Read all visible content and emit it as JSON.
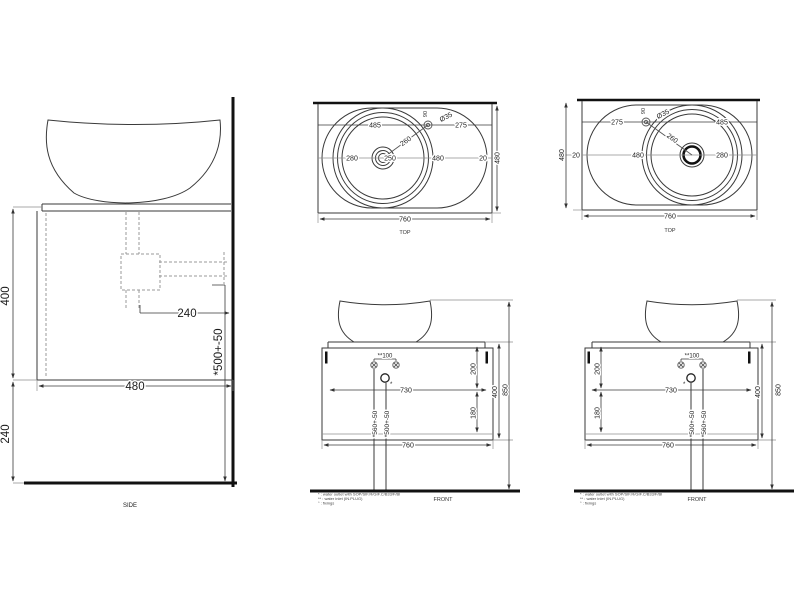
{
  "side": {
    "label": "SIDE",
    "dim_cabinet_height": "400",
    "dim_plinth_height": "240",
    "dim_depth": "480",
    "dim_trap_offset": "240",
    "dim_outlet_height": "*500+-50"
  },
  "top_a": {
    "label": "TOP",
    "dim_edge_to_tap": "485",
    "dim_tap_to_edge": "275",
    "dim_tap_hole": "Ø35",
    "dim_tap_setback": "90",
    "dim_tap_to_drain": "260",
    "dim_edge_to_drain": "280",
    "dim_drain_inner": "250",
    "dim_drain_to_edge": "480",
    "dim_back_gap": "20",
    "dim_depth": "480",
    "dim_width": "760"
  },
  "top_b": {
    "label": "TOP",
    "dim_edge_to_tap": "275",
    "dim_tap_to_edge": "485",
    "dim_tap_hole": "Ø35",
    "dim_tap_setback": "90",
    "dim_tap_to_drain": "260",
    "dim_edge_to_drain": "480",
    "dim_drain_to_edge": "280",
    "dim_back_gap": "20",
    "dim_depth": "480",
    "dim_width": "760"
  },
  "front_a": {
    "label": "FRONT",
    "dim_inlet_spacing": "**100",
    "dim_top_section": "200",
    "dim_bottom_section": "180",
    "dim_span": "730",
    "dim_width": "760",
    "dim_cabinet_height": "400",
    "dim_total_height": "850",
    "dim_pipe_left": "*560+-50",
    "dim_pipe_right": "*500+-50",
    "outlet_mark": "*"
  },
  "front_b": {
    "label": "FRONT",
    "dim_inlet_spacing": "**100",
    "dim_top_section": "200",
    "dim_bottom_section": "180",
    "dim_span": "730",
    "dim_width": "760",
    "dim_cabinet_height": "400",
    "dim_total_height": "850",
    "dim_pipe_left": "*500+-50",
    "dim_pipe_right": "*560+-50",
    "outlet_mark": "*"
  },
  "notes": [
    "* : water outlet with SOP/SIF.R/GIF.C/B33/F/BI",
    "** : water inlet (IN.PLUG)",
    "° : fixings"
  ],
  "colors": {
    "line": "#3a3a3a",
    "thick_line": "#111111",
    "dashed": "#9a9a9a",
    "text": "#1c1c1c",
    "background": "#ffffff"
  }
}
